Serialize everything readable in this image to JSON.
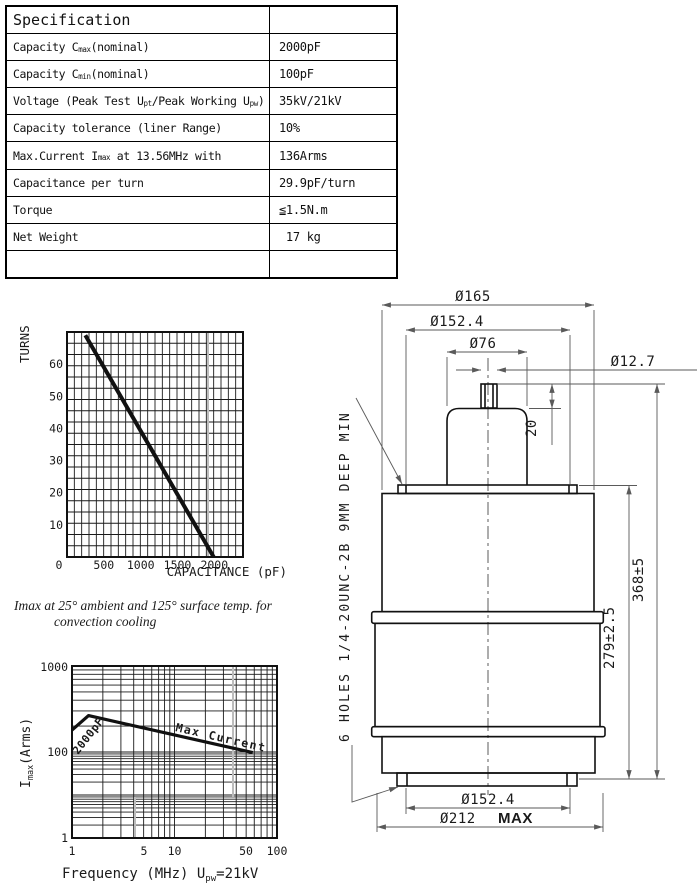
{
  "table": {
    "title": "Specification",
    "rows": [
      {
        "pre": "Capacity C",
        "sub1": "max",
        "mid": "(nominal)",
        "sub2": "",
        "post": "",
        "value": "2000pF"
      },
      {
        "pre": "Capacity C",
        "sub1": "min",
        "mid": "(nominal)",
        "sub2": "",
        "post": "",
        "value": "100pF"
      },
      {
        "pre": "Voltage (Peak Test U",
        "sub1": "pt",
        "mid": "/Peak Working U",
        "sub2": "pw",
        "post": ")",
        "value": "35kV/21kV"
      },
      {
        "pre": "Capacity tolerance (liner Range)",
        "sub1": "",
        "mid": "",
        "sub2": "",
        "post": "",
        "value": "10%"
      },
      {
        "pre": "Max.Current I",
        "sub1": "max",
        "mid": " at 13.56MHz with",
        "sub2": "",
        "post": "",
        "value": "136Arms"
      },
      {
        "pre": "Capacitance per turn",
        "sub1": "",
        "mid": "",
        "sub2": "",
        "post": "",
        "value": "29.9pF/turn"
      },
      {
        "pre": "Torque",
        "sub1": "",
        "mid": "",
        "sub2": "",
        "post": "",
        "value": "≦1.5N.m"
      },
      {
        "pre": "Net Weight",
        "sub1": "",
        "mid": "",
        "sub2": "",
        "post": "",
        "value": " 17 kg"
      },
      {
        "pre": "",
        "sub1": "",
        "mid": "",
        "sub2": "",
        "post": "",
        "value": ""
      }
    ]
  },
  "note": {
    "line1": "Imax at 25°  ambient and 125°  surface temp. for",
    "line2": "convection   cooling"
  },
  "chart_data": [
    {
      "type": "line",
      "title": "",
      "xlabel": "CAPACITANCE (pF)",
      "ylabel": "TURNS",
      "xlim": [
        0,
        2400
      ],
      "ylim": [
        0,
        70
      ],
      "grid": true,
      "xticks": [
        "0",
        "500",
        "1000",
        "1500",
        "2000"
      ],
      "yticks": [
        "10",
        "20",
        "30",
        "40",
        "50",
        "60"
      ],
      "series": [
        {
          "name": "turns-vs-capacitance",
          "x": [
            250,
            2000
          ],
          "y": [
            69,
            0
          ]
        }
      ]
    },
    {
      "type": "line",
      "title": "",
      "xlabel": "Frequency (MHz) Upw=21kV",
      "xlabel_parts": {
        "pre": "Frequency (MHz) U",
        "sub": "pw",
        "post": "=21kV"
      },
      "ylabel": "Imax(Arms)",
      "ylabel_parts": {
        "pre": "I",
        "sub": "max",
        "post": "(Arms)"
      },
      "xscale": "log",
      "yscale": "log",
      "xlim": [
        1,
        100
      ],
      "ylim": [
        1,
        1000
      ],
      "grid": true,
      "xticks": [
        "1",
        "5",
        "10",
        "50",
        "100"
      ],
      "yticks": [
        "1",
        "100",
        "1000"
      ],
      "annotations": [
        "2000pF",
        "Max Current"
      ],
      "series": [
        {
          "name": "Max Current",
          "x": [
            1,
            1.45,
            58
          ],
          "y": [
            180,
            265,
            97
          ]
        }
      ]
    }
  ],
  "drawing": {
    "dims": {
      "d165": "Ø165",
      "d152_top": "Ø152.4",
      "d76": "Ø76",
      "d12_7": "Ø12.7",
      "h20": "20",
      "h368": "368±5",
      "h279": "279±2.5",
      "d152_bot": "Ø152.4",
      "d212": "Ø212",
      "d212_suffix": "MAX",
      "holes_note": "6 HOLES 1/4-20UNC-2B 9MM DEEP MIN"
    }
  }
}
